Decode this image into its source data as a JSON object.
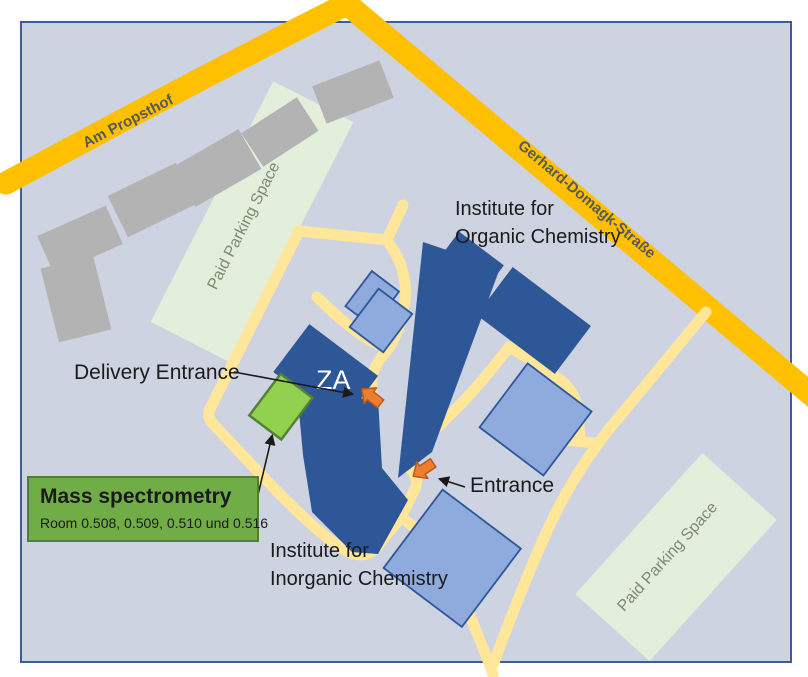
{
  "labels": {
    "street_am_propsthof": "Am Propsthof",
    "street_gerhard": "Gerhard-Domagk-Straße",
    "paid_parking": "Paid Parking Space",
    "institute_for": "Institute for",
    "organic": "Organic Chemistry",
    "inorganic": "Inorganic Chemistry",
    "delivery_entrance": "Delivery Entrance",
    "entrance": "Entrance",
    "za": "ZA",
    "mass_title": "Mass spectrometry",
    "mass_rooms": "Room 0.508, 0.509, 0.510 und 0.516"
  },
  "colors": {
    "map_bg": "#CDD3E1",
    "frame": "#3D5C9C",
    "road": "#FFC001",
    "path": "#FFE699",
    "building_dark": "#2E5797",
    "building_light": "#8FAADC",
    "building_gray": "#B3B3B3",
    "parking": "#E3EFDB",
    "parking_text": "#7E8A74",
    "highlight_green": "#92D050",
    "highlight_border": "#538135",
    "box_green": "#70AD47",
    "box_border": "#507E32",
    "marker_orange": "#ED7D31",
    "marker_border": "#BC5B17",
    "street_text": "#595959",
    "text": "#1A1A1A",
    "za_text": "#FFFFFF"
  }
}
